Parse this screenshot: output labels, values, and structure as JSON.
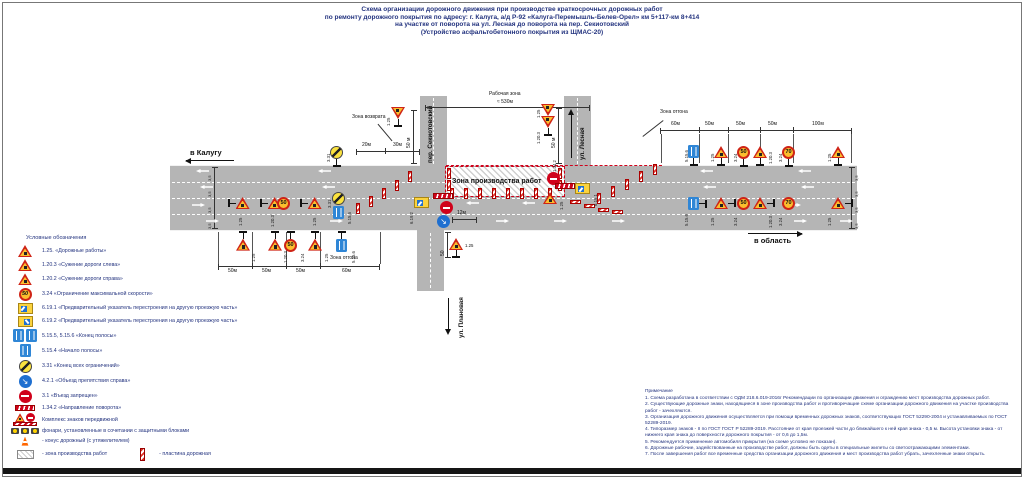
{
  "colors": {
    "accent_text": "#23337f",
    "road": "#b5b5b5",
    "sign_red": "#cf2416",
    "sign_yellow": "#fbbe2e",
    "sign_blue": "#2f86d6",
    "plate_red": "#e03328"
  },
  "title": {
    "line1": "Схема организации дорожного движения при производстве краткосрочных дорожных работ",
    "line2": "по ремонту дорожного покрытия по адресу: г. Калуга, а/д Р-92 «Калуга-Перемышль-Белев-Орел» км 5+117-км 8+414",
    "line3": "на участке от поворота на ул. Лесная до поворота на пер. Секиотовский",
    "line4": "(Устройство асфальтобетонного покрытия из ЩМАС-20)"
  },
  "legend": {
    "header": "Условные обозначения",
    "items": [
      {
        "icon": "sign-roadworks-icon",
        "label": "1.25. «Дорожные работы»"
      },
      {
        "icon": "sign-narrowing-left-icon",
        "label": "1.20.3 «Сужение дороги слева»"
      },
      {
        "icon": "sign-narrowing-right-icon",
        "label": "1.20.2 «Сужение дороги справа»"
      },
      {
        "icon": "sign-speed-limit-icon",
        "label": "3.24 «Ограничение максимальной скорости»"
      },
      {
        "icon": "sign-lane-change-1-icon",
        "label": "6.19.1 «Предварительный указатель перестроения на другую проезжую часть»"
      },
      {
        "icon": "sign-lane-change-2-icon",
        "label": "6.19.2 «Предварительный указатель перестроения на другую проезжую часть»"
      },
      {
        "icon": "sign-lane-end-icon",
        "label": "5.15.5, 5.15.6 «Конец полосы»"
      },
      {
        "icon": "sign-lane-start-icon",
        "label": "5.15.4 «Начало полосы»"
      },
      {
        "icon": "sign-end-restrictions-icon",
        "label": "3.31 «Конец всех ограничений»"
      },
      {
        "icon": "sign-detour-right-icon",
        "label": "4.2.1 «Объезд препятствия справа»"
      },
      {
        "icon": "sign-no-entry-icon",
        "label": "3.1 «Въезд запрещен»"
      },
      {
        "icon": "sign-turn-direction-icon",
        "label": "1.34.2 «Направление поворота»"
      },
      {
        "icon": "mobile-sign-complex-icon",
        "label": "Комплекс знаков передвижной"
      },
      {
        "icon": "warning-lamps-icon",
        "label": "фонари, установленные в сочетании с защитными блоками"
      },
      {
        "icon": "traffic-cone-icon",
        "label": "- конус дорожный (с утяжелителем)"
      },
      {
        "icon": "work-zone-hatch-icon",
        "label": "- зона производства работ"
      },
      {
        "icon": "road-plate-icon",
        "label": "- пластина дорожная"
      }
    ]
  },
  "notes": {
    "header": "Примечание",
    "items": [
      "1. Схема разработана в соответствии с ОДМ 218.6.019-2016г Рекомендации по организации движения и ограждению мест производства дорожных работ.",
      "2. Существующие дорожные знаки, находящиеся в зоне производства работ и противоречащие схеме организации дорожного движения на участке производства работ - зачехляются.",
      "3. Организация дорожного движения осуществляется при помощи временных дорожных знаков, соответствующих ГОСТ 52290-2004 и устанавливаемых по ГОСТ 52289-2019.",
      "4. Типоразмер знаков - II по ГОСТ ГОСТ Р 52289-2019. Расстояние от края проезжей части до ближайшего к ней края знака - 0,5 м. Высота установки знака - от нижнего края знака до поверхности дорожного покрытия - от 0,6 до 1,5м.",
      "5. Рекомендуется применение автомобиля прикрытия (на схеме условно не показан).",
      "6. Дорожные рабочие, задействованные на производстве работ, должны быть одеты в специальные жилеты со светоотражающими элементами.",
      "7. После завершения работ все временные средства организации дорожного движения и мест производства работ убрать, зачехленные знаки открыть."
    ]
  },
  "diagram": {
    "direction_left": "в Калугу",
    "direction_right": "в область",
    "street_sekiotovsky": "пер. Секиотовский",
    "street_lesnaya": "ул. Лесная",
    "street_planovaya": "ул. Плановая",
    "work_area_label": "Рабочая зона",
    "work_area_length": "≈ 530м",
    "work_zone_label": "Зона производства работ",
    "return_zone_label": "Зона возврата",
    "taper_zone_label": "Зона отгона",
    "dim_20": "20м",
    "dim_30": "30м",
    "dim_50": "50м",
    "dim_60": "60м",
    "dim_100": "100м",
    "dim_12": "12м",
    "dim_50_v": "50 м",
    "dim_50_s": "50",
    "lane_width": "3,5"
  },
  "signs": {
    "c125": "1.25",
    "c1203": "1.20.3",
    "c1202": "1.20.2",
    "c324": "3.24",
    "c331": "3.31",
    "c5156": "5.15.6",
    "c6191": "6.19.1",
    "c6192": "6.19.2",
    "c31": "3.1",
    "c421": "4.2.1",
    "c1342": "1.34.2",
    "v50": "50",
    "v70": "70"
  }
}
